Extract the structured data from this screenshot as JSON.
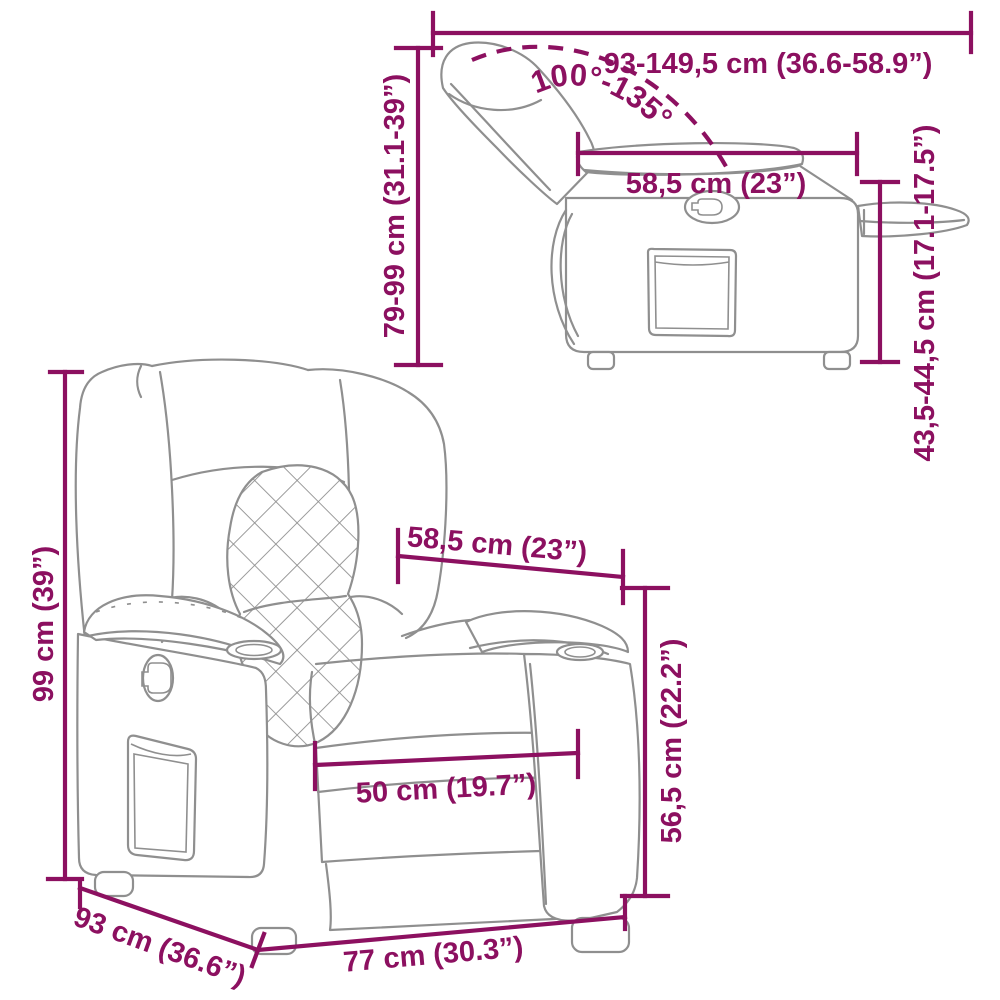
{
  "diagram": {
    "accent_color": "#8c1060",
    "sketch_color": "#8f8f8f",
    "side_view": {
      "total_length_label": "93-149,5 cm (36.6-58.9”)",
      "recline_angle_label": "100°-135°",
      "back_height_label": "79-99 cm (31.1-39”)",
      "seat_depth_label": "58,5 cm (23”)",
      "seat_height_label": "43,5-44,5 cm (17.1-17.5”)"
    },
    "front_view": {
      "overall_height_label": "99 cm (39”)",
      "seat_depth_label": "58,5 cm (23”)",
      "seat_width_label": "50 cm (19.7”)",
      "seat_height_label": "56,5 cm (22.2”)",
      "overall_depth_label": "93 cm (36.6”)",
      "overall_width_label": "77 cm (30.3”)"
    }
  }
}
